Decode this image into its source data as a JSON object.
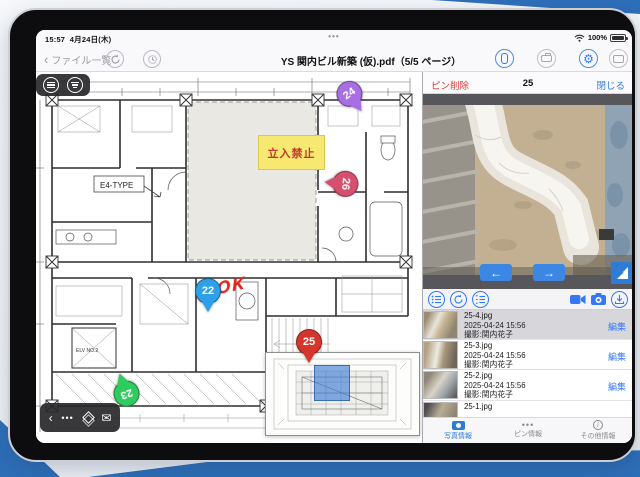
{
  "status_bar": {
    "time": "15:57",
    "date": "4月24日(木)",
    "battery_pct": "100%",
    "multitask_dots": "•••"
  },
  "nav": {
    "back_label": "ファイル一覧",
    "title": "YS 関内ビル新築 (仮).pdf（5/5 ページ）"
  },
  "accent": {
    "blue": "#2e7cd6",
    "red": "#e0382e",
    "frame_blue": "#2e6fba"
  },
  "plan": {
    "no_entry_label": "立入禁止",
    "type_label": "E4-TYPE",
    "elv_label": "ELV NO.2",
    "ok_annotation": "OK",
    "pins": [
      {
        "label": "22",
        "color": "#2f9fe8"
      },
      {
        "label": "23",
        "color": "#2ecc5e"
      },
      {
        "label": "24",
        "color": "#a96de4"
      },
      {
        "label": "25",
        "color": "#d6352c"
      },
      {
        "label": "26",
        "color": "#d64f6e"
      }
    ]
  },
  "panel": {
    "delete_label": "ピン削除",
    "pin_number": "25",
    "close_label": "閉じる",
    "photos": [
      {
        "name": "25-4.jpg",
        "datetime": "2025-04-24 15:56",
        "author": "撮影:関内花子",
        "edit": "編集",
        "selected": true
      },
      {
        "name": "25-3.jpg",
        "datetime": "2025-04-24 15:56",
        "author": "撮影:関内花子",
        "edit": "編集",
        "selected": false
      },
      {
        "name": "25-2.jpg",
        "datetime": "2025-04-24 15:56",
        "author": "撮影:関内花子",
        "edit": "編集",
        "selected": false
      },
      {
        "name": "25-1.jpg",
        "datetime": "",
        "author": "",
        "edit": "",
        "selected": false
      }
    ],
    "tabs": [
      {
        "label": "写真情報",
        "active": true
      },
      {
        "label": "ピン情報",
        "active": false
      },
      {
        "label": "その他情報",
        "active": false
      }
    ]
  }
}
